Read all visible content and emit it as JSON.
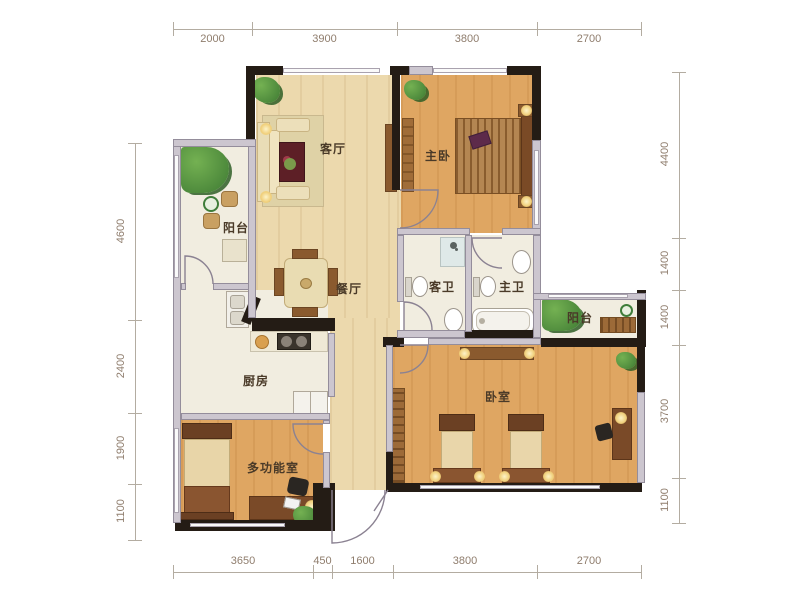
{
  "plan": {
    "rooms": [
      {
        "id": "living-room",
        "label": "客厅",
        "x": 333,
        "y": 148
      },
      {
        "id": "master-bedroom",
        "label": "主卧",
        "x": 438,
        "y": 155
      },
      {
        "id": "balcony-left",
        "label": "阳台",
        "x": 236,
        "y": 227
      },
      {
        "id": "dining-room",
        "label": "餐厅",
        "x": 349,
        "y": 288
      },
      {
        "id": "guest-bathroom",
        "label": "客卫",
        "x": 442,
        "y": 286
      },
      {
        "id": "master-bathroom",
        "label": "主卫",
        "x": 512,
        "y": 286
      },
      {
        "id": "balcony-right",
        "label": "阳台",
        "x": 580,
        "y": 317
      },
      {
        "id": "kitchen",
        "label": "厨房",
        "x": 256,
        "y": 380
      },
      {
        "id": "multi-function-room",
        "label": "多功能室",
        "x": 273,
        "y": 467
      },
      {
        "id": "bedroom",
        "label": "卧室",
        "x": 498,
        "y": 396
      }
    ],
    "dimensions": {
      "top": {
        "values": [
          "2000",
          "3900",
          "3800",
          "2700"
        ],
        "ticks": [
          173,
          252,
          397,
          537,
          641
        ],
        "pos": 29
      },
      "bottom": {
        "values": [
          "3650",
          "450",
          "1600",
          "3800",
          "2700"
        ],
        "ticks": [
          173,
          313,
          332,
          393,
          537,
          641
        ],
        "pos": 572
      },
      "left": {
        "values": [
          "4600",
          "2400",
          "1900",
          "1100"
        ],
        "ticks": [
          143,
          320,
          413,
          484,
          540
        ],
        "pos": 135
      },
      "right": {
        "values": [
          "4400",
          "1400",
          "1400",
          "3700",
          "1100"
        ],
        "ticks": [
          72,
          238,
          290,
          345,
          478,
          523
        ],
        "pos": 679
      }
    },
    "colors": {
      "wall_black": "#241c15",
      "partition_gray": "#ccc6cf",
      "wood_light": "#ecd9ad",
      "wood_orange": "#dfa662",
      "floor_cream": "#f1ede0",
      "dim_text": "#8f7d6d",
      "label_text": "#4a3a28",
      "plant_green": "#4e8a3c",
      "lamp_glow": "#f0cf7a"
    }
  }
}
